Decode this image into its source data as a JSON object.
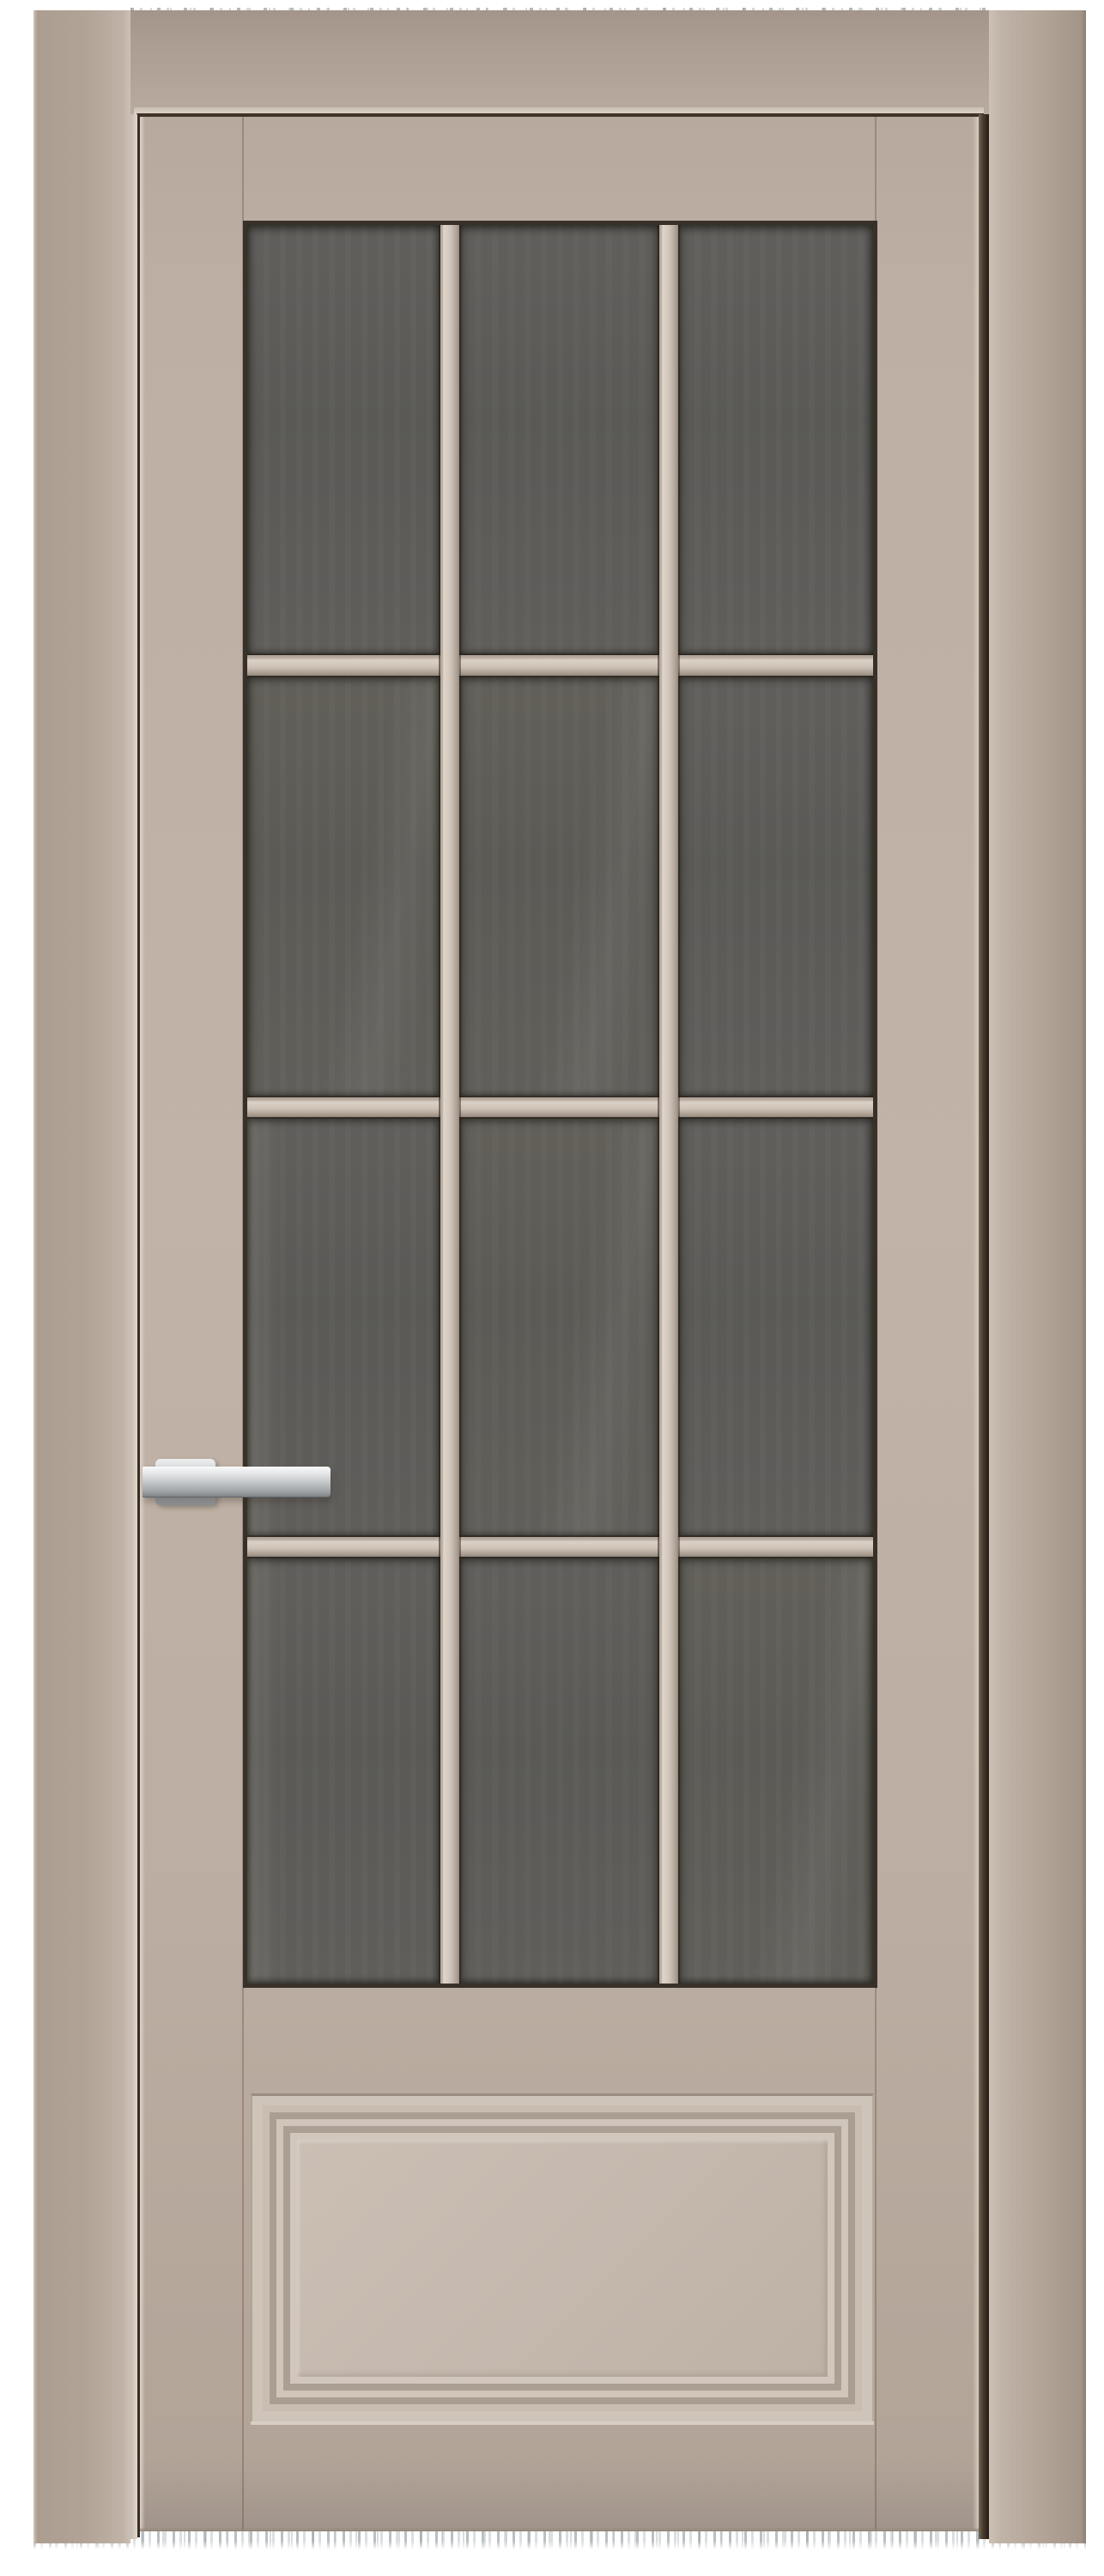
{
  "scene": {
    "type": "product photo",
    "description": "Closed interior door, front view, on a plain white background. Sandstone-beige painted frame and leaf, twelve dark smoked glass panes arranged 3 columns by 4 rows with beige glazing bars, a solid raised bottom panel with stepped molding, and a brushed chrome lever handle mounted on the left stile pointing right. Faint horizontal motion-blur streak artifacts appear along the very top and bottom edges of the photo.",
    "background_color": "#ffffff"
  },
  "door": {
    "finish_name": "sandstone beige",
    "frame_color": "#b1a396",
    "leaf_color": "#bdafa3",
    "glazing_bar_color": "#cfc3b8",
    "glass_color": "#5d5b58",
    "gap_shadow_color": "#3a2e24",
    "glass_grid": {
      "columns": 3,
      "rows": 4,
      "panes": 12
    },
    "bottom_panel_style": "raised panel with stepped concentric molding",
    "handle": {
      "type": "lever handle on rectangular rosette",
      "finish": "brushed chrome",
      "color": "#c2c5c7",
      "mounted_side": "left",
      "points": "right"
    }
  }
}
